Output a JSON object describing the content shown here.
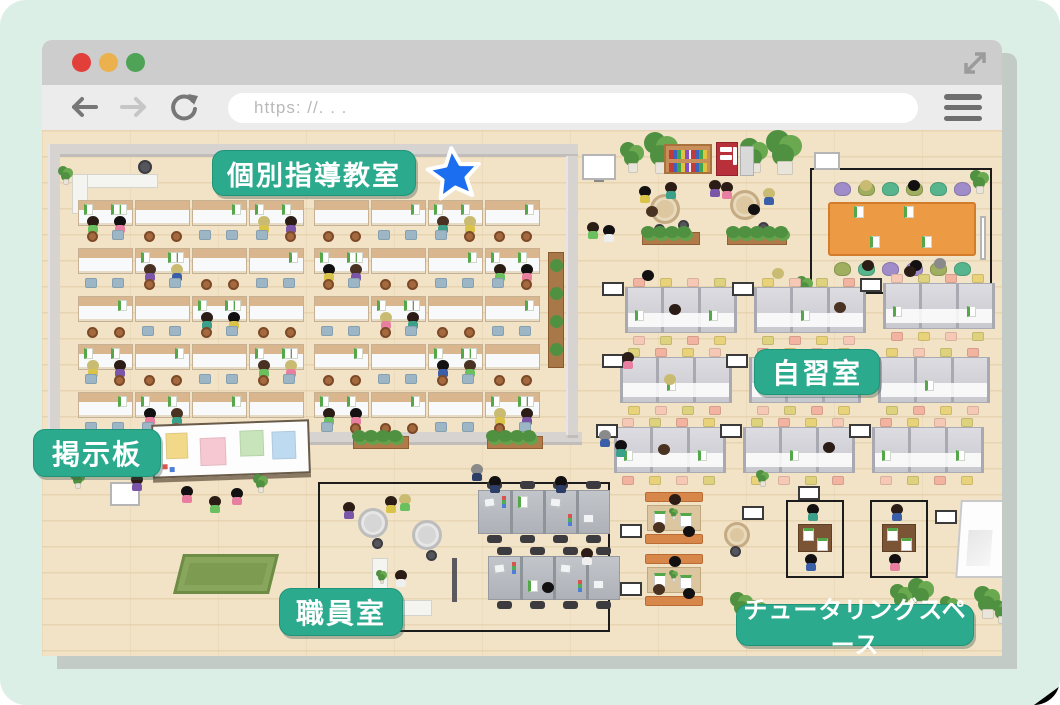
{
  "browser": {
    "url": "https: //. . .",
    "traffic_lights": {
      "close": "#e23f3a",
      "minimize": "#eab14e",
      "maximize": "#4fa357"
    }
  },
  "labels": {
    "classroom": "個別指導教室",
    "study_room": "自習室",
    "bulletin_board": "掲示板",
    "staff_room": "職員室",
    "tutoring_space": "チュータリングスペース"
  },
  "theme": {
    "label_bg": "#2caa8e",
    "star_fill": "#1b6ef0",
    "floor": "#f2e3c6",
    "page_background": "#dcefe7",
    "titlebar": "#cdcdcd",
    "toolbar": "#ececec"
  },
  "map": {
    "classroom": {
      "rows": 5,
      "groups": 2,
      "desks_per_group": 4
    },
    "study_room": {
      "cubicle_blocks": 9
    },
    "staff_room": {
      "desk_clusters": 2
    },
    "tutoring": {
      "booths": 2,
      "bench_booths": 2
    }
  }
}
